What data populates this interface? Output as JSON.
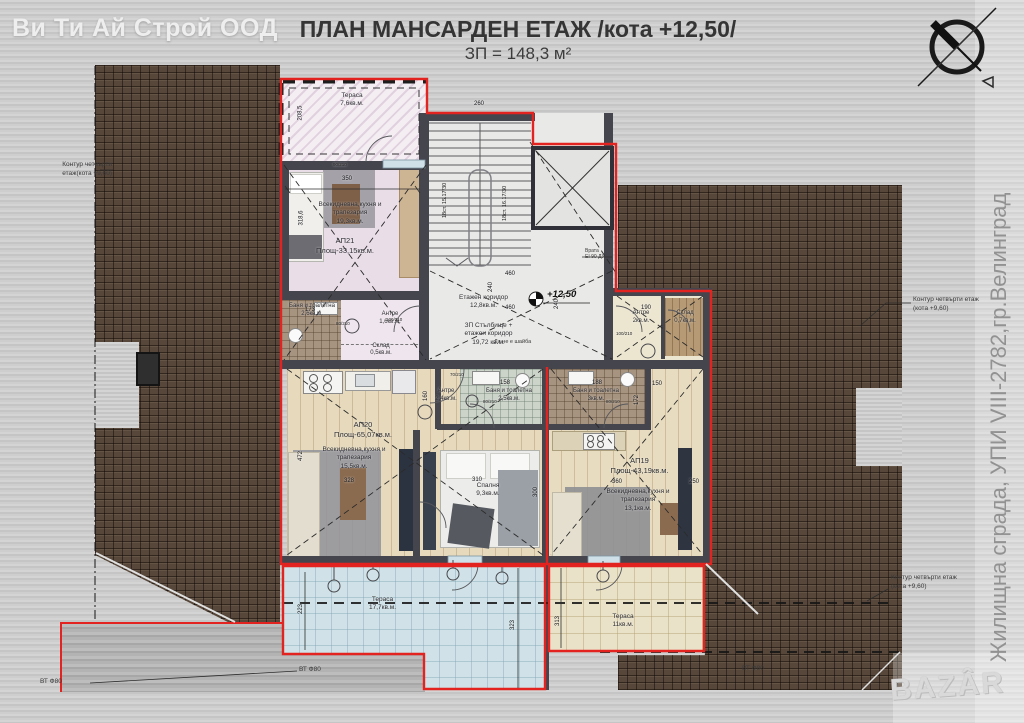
{
  "header": {
    "company": "Ви Ти Ай Строй ООД",
    "title": "ПЛАН МАНСАРДЕН ЕТАЖ /кота +12,50/",
    "subtitle": "ЗП = 148,3 м²"
  },
  "side": {
    "project": "Жилищна сграда, УПИ VIII-2782,гр.Велинград",
    "bazar": "BAZÂR"
  },
  "notes": {
    "contour_left": "Контур четвърти\nетаж(кота +9,60)",
    "contour_right_top": "Контур четвърти етаж\n(кота +9,60)",
    "contour_right_bottom": "Контур четвърти етаж\n(кота +9,60)",
    "pipe_left": "ВТ Ф80",
    "pipe_mid": "ВТ Ф80",
    "pipe_right": "ВТ Ф80",
    "door_note": "Врата\nEI 90 ДУ",
    "no_washer": "Да не е шайба",
    "level": "+12,50"
  },
  "stair": {
    "corridor": "Етажен коридор\n12,8кв.м.",
    "total": "ЗП Стълбище +\nетажен коридор\n19,72 кв.м.",
    "flight_left": "18ст. 15.17/30",
    "flight_right": "18ст. 16.17/30"
  },
  "ap21": {
    "name_area": "АП21\nПлощ-33,15кв.м.",
    "terrace": "Тераса\n7,6кв.м.",
    "living": "Всекидневна,кухня и\nтрапезария\n19,3кв.м.",
    "bath": "Баня и тоалетна\n2,6кв.м.",
    "antre": "Антре\n1,6кв.м.",
    "storage": "Склад\n0,5кв.м."
  },
  "ap20": {
    "name_area": "АП20\nПлощ-65,07кв.м.",
    "living": "Всекидневна,кухня и\nтрапезария\n15,5кв.м.",
    "antre": "Антре\n2,4кв.м.",
    "bath": "Баня и тоалетна\n2,5кв.м.",
    "bedroom": "Спалня\n9,3кв.м.",
    "terrace": "Тераса\n17,7кв.м."
  },
  "ap19": {
    "name_area": "АП19\nПлощ-43,19кв.м.",
    "living": "Всекидневна,кухня и\nтрапезария\n13,1кв.м.",
    "antre": "Антре\n2кв.м.",
    "storage": "Склад\n0,7кв.м.",
    "bath": "Баня и тоалетна\n3кв.м.",
    "terrace": "Тераса\n11кв.м."
  },
  "dims": {
    "t350": "350",
    "t208": "208,5",
    "l318": "318,6",
    "s260": "260",
    "s460a": "460",
    "s240a": "240",
    "s460b": "460",
    "s240b": "240",
    "b173": "173",
    "b158": "158",
    "b188": "188",
    "a190": "190",
    "a150": "150",
    "a172": "172",
    "k160": "160",
    "l328": "328",
    "l472": "472",
    "bed310": "310",
    "bed300": "300",
    "l360": "360",
    "r250": "250",
    "ter223": "223",
    "ter323": "323",
    "ter313": "313"
  },
  "door_sizes": [
    "90/210",
    "80/210",
    "100/210",
    "70/210",
    "80/210",
    "100/210",
    "80/210"
  ]
}
